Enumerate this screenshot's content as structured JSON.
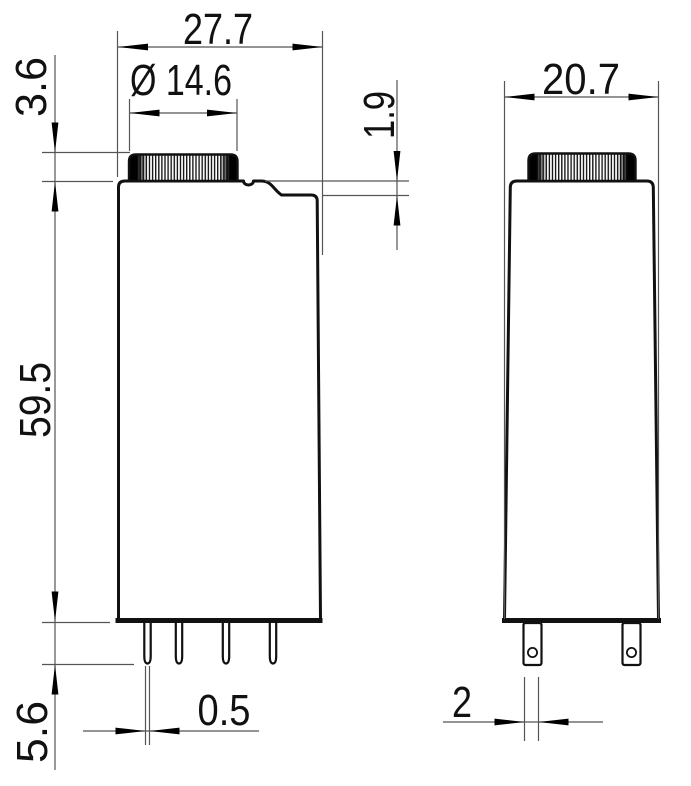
{
  "drawing": {
    "type": "technical-dimension-drawing",
    "views": {
      "front": "front-view",
      "side": "side-view"
    },
    "dimensions": {
      "front_width": "27.7",
      "knob_diameter": "Ø 14.6",
      "knob_height": "3.6",
      "collar_step": "1.9",
      "body_height": "59.5",
      "pin_length": "5.6",
      "pin_thickness": "0.5",
      "side_width": "20.7",
      "pin_width": "2"
    },
    "colors": {
      "outline": "#111111",
      "dimension_lines": "#555555",
      "arrows": "#000000",
      "text": "#111111",
      "background": "#ffffff"
    }
  }
}
